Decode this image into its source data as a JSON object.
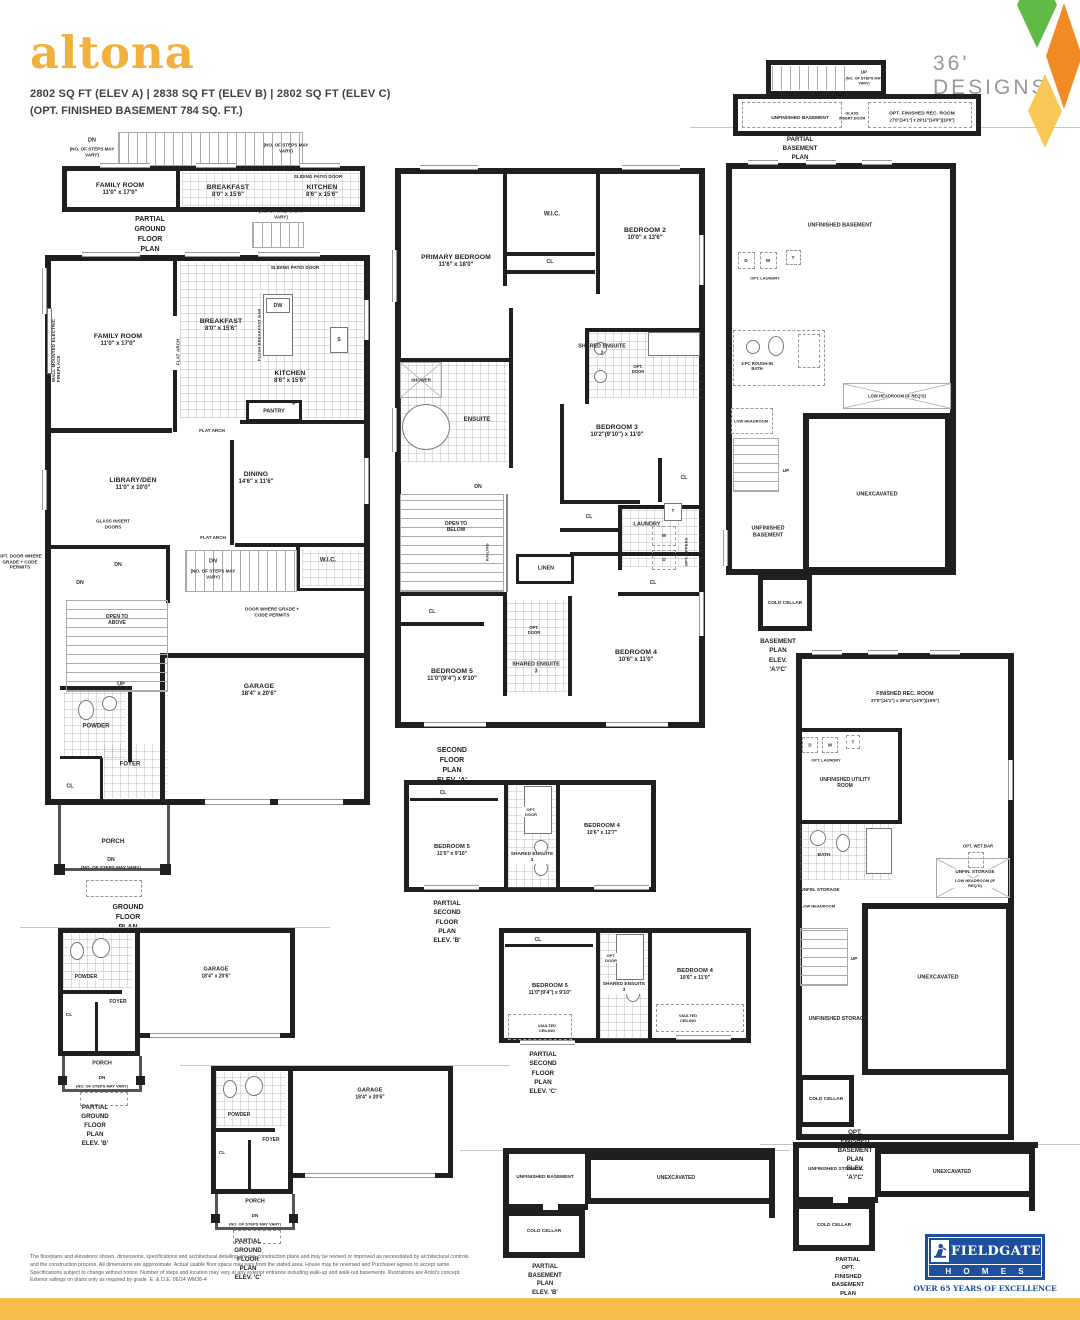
{
  "header": {
    "title": "altona",
    "specs": "2802 SQ FT (ELEV A)   |   2838 SQ FT (ELEV B)   |   2802 SQ FT (ELEV C)",
    "opt_basement": "(OPT. FINISHED BASEMENT 784 SQ. FT.)",
    "designs": "36' DESIGNS"
  },
  "colors": {
    "accent_yellow": "#F2B03C",
    "bar_yellow": "#F8BC4A",
    "diamond_green": "#5FBB46",
    "diamond_orange": "#F08A23",
    "diamond_yellow": "#F9C857",
    "logo_blue": "#1E4F9E"
  },
  "plans": {
    "p1": {
      "rooms": {
        "family": {
          "name": "FAMILY ROOM",
          "dims": "11'0\" x 17'0\""
        },
        "breakfast": {
          "name": "BREAKFAST",
          "dims": "8'0\" x 15'6\""
        },
        "kitchen": {
          "name": "KITCHEN",
          "dims": "8'6\" x 15'6\""
        }
      },
      "notes": {
        "dn": "DN",
        "steps_l": "(NO. OF STEPS MAY VARY)",
        "steps_r": "(NO. OF STEPS MAY VARY)",
        "patio": "SLIDING PATIO DOOR"
      },
      "caption": {
        "c1": "PARTIAL GROUND FLOOR PLAN",
        "c2": "OPT. WALK-UP BASEMENT CONDITION",
        "c3": "(SUBJECT TO GRADING APPROVAL)",
        "c4": "(LOCATION MAY VARY)"
      }
    },
    "p2": {
      "rooms": {
        "family": {
          "name": "FAMILY ROOM",
          "dims": "11'0\" x 17'0\""
        },
        "breakfast": {
          "name": "BREAKFAST",
          "dims": "8'0\" x 15'6\""
        },
        "kitchen": {
          "name": "KITCHEN",
          "dims": "8'6\" x 15'6\""
        },
        "pantry": {
          "name": "PANTRY"
        },
        "dining": {
          "name": "DINING",
          "dims": "14'6\" x 11'6\""
        },
        "library": {
          "name": "LIBRARY/DEN",
          "dims": "11'0\" x 10'0\""
        },
        "wic": {
          "name": "W.I.C."
        },
        "garage": {
          "name": "GARAGE",
          "dims": "18'4\" x 20'6\""
        },
        "powder": {
          "name": "POWDER"
        },
        "foyer": {
          "name": "FOYER"
        },
        "cl": {
          "name": "CL"
        },
        "porch": {
          "name": "PORCH"
        }
      },
      "notes": {
        "fireplace": "WALL MOUNTED ELECTRIC FIREPLACE",
        "flat_arch": "FLAT ARCH",
        "flush_bar": "FLUSH BREAKFAST BAR",
        "dw": "DW",
        "s": "S",
        "f": "F",
        "patio": "SLIDING PATIO DOOR",
        "steps": "(NO. OF STEPS MAY VARY)",
        "glass": "GLASS INSERT DOORS",
        "dn": "DN",
        "open_above": "OPEN TO ABOVE",
        "up": "UP",
        "door_grade": "DOOR WHERE GRADE + CODE PERMITS",
        "opt_door_grade": "OPT. DOOR WHERE GRADE + CODE PERMITS"
      },
      "caption": {
        "c1": "GROUND FLOOR PLAN",
        "c2": "ELEV. 'A'"
      }
    },
    "p3": {
      "rooms": {
        "primary": {
          "name": "PRIMARY BEDROOM",
          "dims": "11'6\" x 18'0\""
        },
        "wic": {
          "name": "W.I.C."
        },
        "bedroom2": {
          "name": "BEDROOM 2",
          "dims": "10'0\" x 13'6\""
        },
        "ensuite2": {
          "name": "SHARED ENSUITE 2"
        },
        "shower": {
          "name": "SHOWER"
        },
        "ensuite": {
          "name": "ENSUITE"
        },
        "bedroom3": {
          "name": "BEDROOM 3",
          "dims": "10'2\"(9'10\") x 11'0\""
        },
        "laundry": {
          "name": "LAUNDRY"
        },
        "open_below": {
          "name": "OPEN TO BELOW"
        },
        "linen": {
          "name": "LINEN"
        },
        "bedroom5": {
          "name": "BEDROOM 5",
          "dims": "11'0\"(9'4\") x 9'10\""
        },
        "ensuite3": {
          "name": "SHARED ENSUITE 3"
        },
        "bedroom4": {
          "name": "BEDROOM 4",
          "dims": "10'6\" x 11'0\""
        }
      },
      "notes": {
        "cl": "CL",
        "opt_door": "OPT. DOOR",
        "dn": "DN",
        "railing": "RAILING",
        "w": "W",
        "d": "D",
        "t": "T",
        "opt_uppers": "OPT. UPPERS"
      },
      "caption": {
        "c1": "SECOND FLOOR PLAN",
        "c2": "ELEV. 'A'"
      }
    },
    "p4": {
      "rooms": {
        "unfin": {
          "name": "UNFINISHED BASEMENT"
        },
        "rec": {
          "name": "OPT. FINISHED REC. ROOM",
          "dims": "27'0\"(14'1\") x 29'11\"(14'9\")(19'9\")"
        }
      },
      "notes": {
        "up": "UP",
        "steps": "(NO. OF STEPS MAY VARY)",
        "glass": "GLASS INSERT DOOR"
      },
      "caption": {
        "c1": "PARTIAL BASEMENT PLAN",
        "c2": "OPT. WALK-UP BASEMENT CONDITION",
        "c3": "(SUBJECT TO GRADING APPROVAL)",
        "c4": "(LOCATION MAY VARY)"
      }
    },
    "p5": {
      "rooms": {
        "unfin_top": {
          "name": "UNFINISHED BASEMENT"
        },
        "bath": {
          "name": "3-PC ROUGH-IN BATH"
        },
        "unex": {
          "name": "UNEXCAVATED"
        },
        "unfin_low": {
          "name": "UNFINISHED BASEMENT"
        },
        "cold": {
          "name": "COLD CELLAR"
        }
      },
      "notes": {
        "d": "D",
        "w": "W",
        "t": "T",
        "opt_laundry": "OPT. LAUNDRY",
        "low_head": "LOW HEADROOM (IF REQ'D)",
        "low_head2": "LOW HEADROOM",
        "up": "UP"
      },
      "caption": {
        "c1": "BASEMENT PLAN",
        "c2": "ELEV. 'A'/'C'"
      }
    },
    "p6": {
      "rooms": {
        "rec": {
          "name": "FINISHED REC. ROOM",
          "dims": "27'0\"(14'1\") x 29'11\"(14'9\")(19'9\")"
        },
        "utility": {
          "name": "UNFINISHED UTILITY ROOM"
        },
        "bath": {
          "name": "BATH"
        },
        "storage_a": {
          "name": "UNFIN. STORAGE"
        },
        "storage_b": {
          "name": "UNFIN. STORAGE"
        },
        "unex": {
          "name": "UNEXCAVATED"
        },
        "storage_c": {
          "name": "UNFINISHED STORAGE"
        },
        "cold": {
          "name": "COLD CELLAR"
        }
      },
      "notes": {
        "d": "D",
        "w": "W",
        "t": "T",
        "opt_laundry": "OPT. LAUNDRY",
        "wet_bar": "OPT. WET BAR",
        "low_head": "LOW HEADROOM (IF REQ'D)",
        "low_head2": "LOW HEADROOM",
        "up": "UP"
      },
      "caption": {
        "c1": "OPT. FINISHED BASEMENT PLAN",
        "c2": "ELEV. 'A'/'C'"
      }
    },
    "p7": {
      "rooms": {
        "bedroom5": {
          "name": "BEDROOM 5",
          "dims": "11'0\" x 9'10\""
        },
        "ensuite3": {
          "name": "SHARED ENSUITE 3"
        },
        "bedroom4": {
          "name": "BEDROOM 4",
          "dims": "10'6\" x 12'7\""
        },
        "cl": {
          "name": "CL"
        }
      },
      "notes": {
        "opt_door": "OPT. DOOR"
      },
      "caption": {
        "c1": "PARTIAL SECOND FLOOR PLAN",
        "c2": "ELEV. 'B'"
      }
    },
    "p8": {
      "rooms": {
        "bedroom5": {
          "name": "BEDROOM 5",
          "dims": "11'0\"(9'4\") x 9'10\""
        },
        "ensuite3": {
          "name": "SHARED ENSUITE 3"
        },
        "bedroom4": {
          "name": "BEDROOM 4",
          "dims": "10'6\" x 11'0\""
        },
        "cl": {
          "name": "CL"
        }
      },
      "notes": {
        "opt_door": "OPT. DOOR",
        "vaulted": "VAULTED CEILING"
      },
      "caption": {
        "c1": "PARTIAL SECOND FLOOR PLAN",
        "c2": "ELEV. 'C'"
      }
    },
    "p9": {
      "rooms": {
        "powder": {
          "name": "POWDER"
        },
        "foyer": {
          "name": "FOYER"
        },
        "cl": {
          "name": "CL"
        },
        "garage": {
          "name": "GARAGE",
          "dims": "18'4\" x 20'6\""
        },
        "porch": {
          "name": "PORCH"
        }
      },
      "notes": {
        "dn": "DN",
        "steps": "(NO. OF STEPS MAY VARY)"
      },
      "caption": {
        "c1": "PARTIAL GROUND FLOOR PLAN",
        "c2": "ELEV. 'B'"
      }
    },
    "p10": {
      "rooms": {
        "powder": {
          "name": "POWDER"
        },
        "foyer": {
          "name": "FOYER"
        },
        "cl": {
          "name": "CL"
        },
        "garage": {
          "name": "GARAGE",
          "dims": "18'4\" x 20'6\""
        },
        "porch": {
          "name": "PORCH"
        }
      },
      "notes": {
        "dn": "DN",
        "steps": "(NO. OF STEPS MAY VARY)"
      },
      "caption": {
        "c1": "PARTIAL GROUND FLOOR PLAN",
        "c2": "ELEV. 'C'"
      }
    },
    "p11": {
      "rooms": {
        "unfin": {
          "name": "UNFINISHED BASEMENT"
        },
        "unex": {
          "name": "UNEXCAVATED"
        },
        "cold": {
          "name": "COLD CELLAR"
        }
      },
      "caption": {
        "c1": "PARTIAL BASEMENT PLAN",
        "c2": "ELEV. 'B'"
      }
    },
    "p12": {
      "rooms": {
        "storage": {
          "name": "UNFINISHED STORAGE"
        },
        "unex": {
          "name": "UNEXCAVATED"
        },
        "cold": {
          "name": "COLD CELLAR"
        }
      },
      "caption": {
        "c1": "PARTIAL OPT. FINISHED BASEMENT PLAN",
        "c2": "ELEV. 'B'"
      }
    }
  },
  "footer": {
    "disclaimer1": "The floorplans and elevations shown, dimensions, specifications and architectural detailing are pre-construction plans and may be revised or improved as necessitated by architectural controls",
    "disclaimer2": "and the construction process. All dimensions are approximate. Actual usable floor space may vary from the stated area. House may be reversed and Purchaser agrees to accept same.",
    "disclaimer3": "Specifications subject to change without notice. Number of steps and location may vary at any exterior entrance including walk-up and walk-out basements. Illustrations are Artist's concept.",
    "disclaimer4": "Exterior railings on plans only as required by grade. E. & O.E. 06/24 WM36-4",
    "logo": {
      "name": "FIELDGATE",
      "homes": "H O M E S",
      "tagline": "OVER 65 YEARS OF EXCELLENCE"
    }
  }
}
